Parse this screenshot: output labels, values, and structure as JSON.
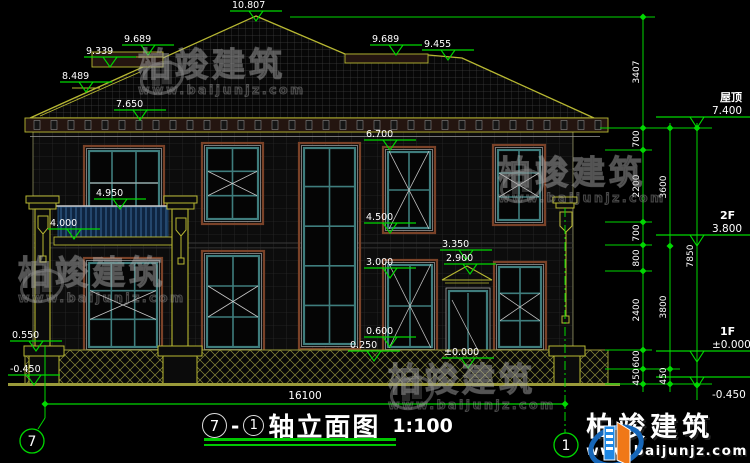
{
  "watermark": {
    "name": "柏竣建筑",
    "url": "www.baijunjz.com"
  },
  "brand": {
    "name": "柏竣建筑",
    "url": "www.baijunjz.com"
  },
  "title_block": {
    "axis_from": "7",
    "separator": "-",
    "axis_to": "1",
    "name": "轴立面图",
    "scale": "1:100"
  },
  "axis_bubbles": [
    {
      "label": "7",
      "cx": 32,
      "cy": 441
    },
    {
      "label": "1",
      "cx": 566,
      "cy": 445
    }
  ],
  "colors": {
    "dim_green": "#00d800",
    "line_yellow": "#b8b832",
    "window_teal": "#3f7d7d",
    "trim_brown": "#7a4228",
    "brand_blue": "#1666b8",
    "brand_orange": "#f07818",
    "text_white": "#ffffff"
  },
  "drawing": {
    "elevation_markers": [
      {
        "label": "10.807",
        "x": 230,
        "y": 11
      },
      {
        "label": "9.689",
        "x": 122,
        "y": 45
      },
      {
        "label": "9.339",
        "x": 84,
        "y": 57
      },
      {
        "label": "8.489",
        "x": 60,
        "y": 82
      },
      {
        "label": "7.650",
        "x": 114,
        "y": 110
      },
      {
        "label": "9.689",
        "x": 370,
        "y": 45
      },
      {
        "label": "9.455",
        "x": 422,
        "y": 50
      },
      {
        "label": "6.700",
        "x": 364,
        "y": 140
      },
      {
        "label": "4.950",
        "x": 94,
        "y": 199
      },
      {
        "label": "4.000",
        "x": 48,
        "y": 229
      },
      {
        "label": "4.500",
        "x": 364,
        "y": 223
      },
      {
        "label": "3.000",
        "x": 364,
        "y": 268
      },
      {
        "label": "3.350",
        "x": 440,
        "y": 250
      },
      {
        "label": "2.900",
        "x": 444,
        "y": 264
      },
      {
        "label": "0.600",
        "x": 364,
        "y": 337
      },
      {
        "label": "0.250",
        "x": 348,
        "y": 351
      },
      {
        "label": "±0.000",
        "x": 442,
        "y": 358
      },
      {
        "label": "0.550",
        "x": 10,
        "y": 341
      },
      {
        "label": "-0.450",
        "x": 8,
        "y": 375
      }
    ],
    "right_levels": [
      {
        "name": "屋顶",
        "value": "7.400",
        "y": 128,
        "below": false
      },
      {
        "name": "2F",
        "value": "3.800",
        "y": 246,
        "below": false
      },
      {
        "name": "1F",
        "value": "±0.000",
        "y": 362,
        "below": false
      },
      {
        "name": "",
        "value": "-0.450",
        "y": 388,
        "below": true
      }
    ],
    "dim_chains": [
      {
        "x": 643,
        "y1": 15,
        "y2": 392,
        "ticks": [
          17,
          128,
          150,
          222,
          245,
          271,
          350,
          369,
          384
        ],
        "labels": [
          {
            "t": "3407",
            "y": 72
          },
          {
            "t": "700",
            "y": 139
          },
          {
            "t": "2200",
            "y": 186
          },
          {
            "t": "700",
            "y": 233
          },
          {
            "t": "800",
            "y": 258
          },
          {
            "t": "2400",
            "y": 310
          },
          {
            "t": "600",
            "y": 359
          },
          {
            "t": "450",
            "y": 377
          }
        ]
      },
      {
        "x": 670,
        "y1": 123,
        "y2": 392,
        "ticks": [
          128,
          246,
          369,
          384
        ],
        "labels": [
          {
            "t": "3600",
            "y": 187
          },
          {
            "t": "3800",
            "y": 307
          },
          {
            "t": "450",
            "y": 376
          }
        ]
      },
      {
        "x": 697,
        "y1": 123,
        "y2": 400,
        "ticks": [
          128,
          385
        ],
        "labels": [
          {
            "t": "7850",
            "y": 256
          }
        ]
      }
    ],
    "extensions": [
      {
        "x1": 290,
        "x2": 655,
        "y": 17
      },
      {
        "x1": 600,
        "x2": 712,
        "y": 128
      },
      {
        "x1": 605,
        "x2": 652,
        "y": 150
      },
      {
        "x1": 605,
        "x2": 652,
        "y": 222
      },
      {
        "x1": 605,
        "x2": 652,
        "y": 245
      },
      {
        "x1": 605,
        "x2": 652,
        "y": 271
      },
      {
        "x1": 605,
        "x2": 652,
        "y": 350
      },
      {
        "x1": 605,
        "x2": 680,
        "y": 369
      },
      {
        "x1": 605,
        "x2": 712,
        "y": 384
      }
    ],
    "bottom_dim": {
      "label": "16100",
      "y": 404,
      "x1": 45,
      "x2": 565,
      "label_x": 305,
      "label_y": 399
    }
  }
}
